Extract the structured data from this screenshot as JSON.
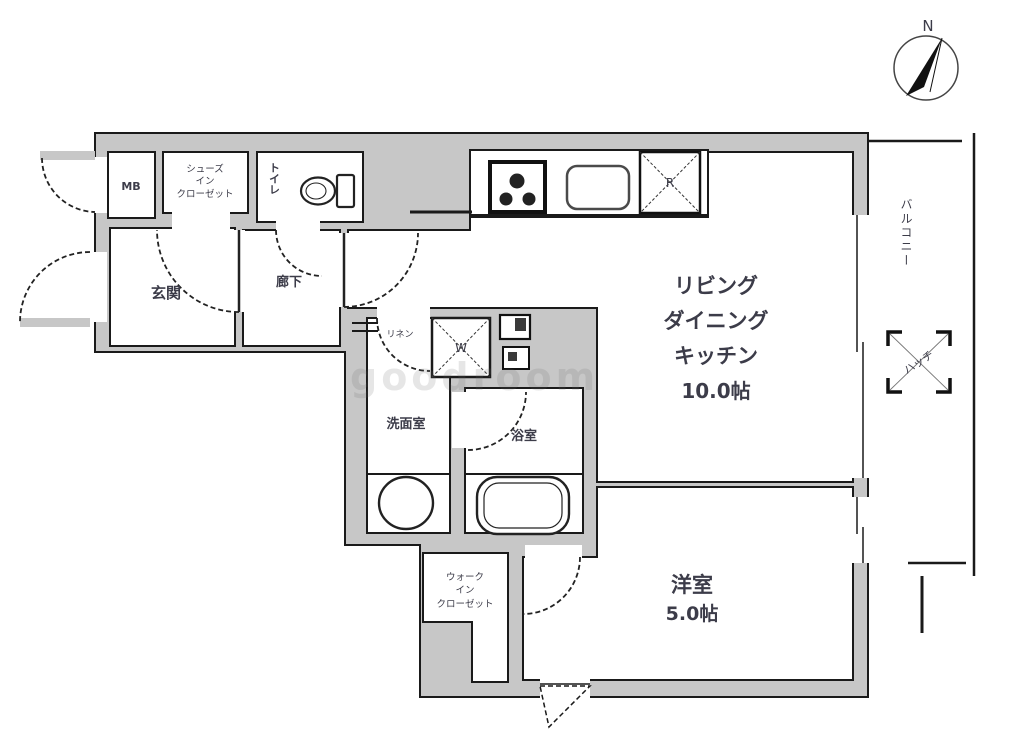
{
  "plan": {
    "watermark": "goodroom",
    "compass": {
      "north_label": "N"
    },
    "ldk": {
      "lines": [
        "リビング",
        "ダイニング",
        "キッチン"
      ],
      "size": "10.0帖"
    },
    "bedroom": {
      "name": "洋室",
      "size": "5.0帖"
    },
    "entrance": {
      "name": "玄関"
    },
    "hallway": {
      "name": "廊下"
    },
    "toilet": {
      "name": "トイレ"
    },
    "meter_box": {
      "name": "MB"
    },
    "shoes_closet": {
      "lines": [
        "シューズ",
        "イン",
        "クローゼット"
      ]
    },
    "washroom": {
      "name": "洗面室"
    },
    "linen": {
      "name": "リネン"
    },
    "bathroom": {
      "name": "浴室"
    },
    "walk_in_closet": {
      "lines": [
        "ウォーク",
        "イン",
        "クローゼット"
      ]
    },
    "balcony": {
      "name": "バルコニー"
    },
    "hatch": {
      "name": "ハッチ"
    },
    "washing_machine_mark": "W",
    "refrigerator_mark": "R"
  },
  "colors": {
    "wall_fill": "#c7c7c7",
    "line": "#1a1a1a",
    "label_text": "#3c3c49"
  }
}
